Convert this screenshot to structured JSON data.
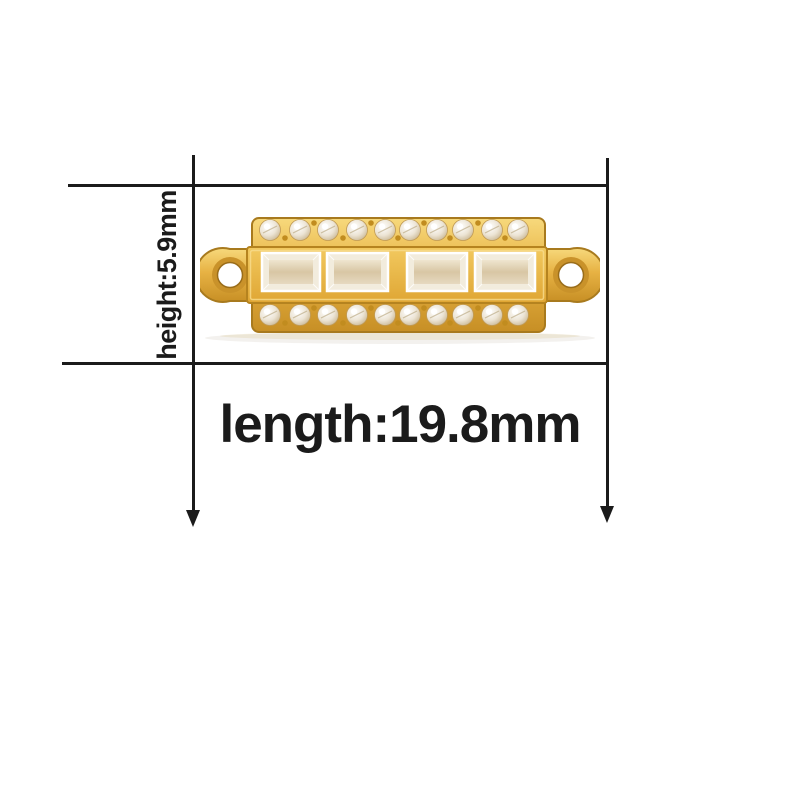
{
  "diagram": {
    "height_annotation": {
      "label": "height:5.9mm",
      "value": "5.9",
      "unit": "mm"
    },
    "length_annotation": {
      "label": "length:19.8mm",
      "value": "19.8",
      "unit": "mm"
    },
    "image": {
      "alt": "gold rectangular pave bar connector charm with a loop on each end, top and bottom rows of ten round crystals and four baguette crystals in the middle band"
    },
    "icons": {
      "length_extent_left": "arrow-down-icon",
      "length_extent_right": "arrow-down-icon"
    },
    "colors": {
      "background": "#ffffff",
      "line": "#1b1b1b",
      "text": "#1b1b1b",
      "gold_light": "#f7d97c",
      "gold": "#e7b243",
      "gold_dark": "#c78f25",
      "gold_outline": "#a87a1e",
      "crystal_light": "#ffffff",
      "crystal": "#ece4d4",
      "crystal_dark": "#c6b28c"
    }
  }
}
